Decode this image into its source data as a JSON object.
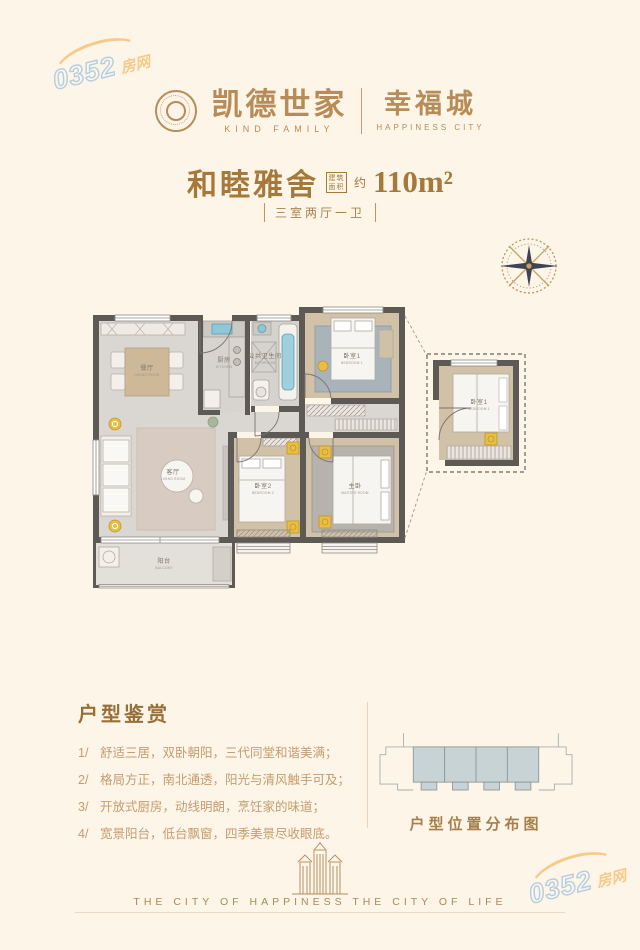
{
  "watermark": {
    "number": "0352",
    "suffix": "房网"
  },
  "header": {
    "brand_cn": "凯德世家",
    "brand_en": "KIND FAMILY",
    "project_cn": "幸福城",
    "project_en": "HAPPINESS CITY"
  },
  "title": {
    "name": "和睦雅舍",
    "area_label": "建筑面积",
    "approx": "约",
    "area_value": "110m²",
    "layout": "三室两厅一卫"
  },
  "floorplan": {
    "rooms": {
      "dining": {
        "cn": "餐厅",
        "en": "DINING ROOM"
      },
      "kitchen": {
        "cn": "厨房",
        "en": "KITCHEN"
      },
      "bath": {
        "cn": "公共卫生间",
        "en": "BATHROOM"
      },
      "bedroom1": {
        "cn": "卧室1",
        "en": "BEDROOM 1"
      },
      "living": {
        "cn": "客厅",
        "en": "LIVING ROOM"
      },
      "bedroom2": {
        "cn": "卧室2",
        "en": "BEDROOM 2"
      },
      "master": {
        "cn": "主卧",
        "en": "MASTER ROOM"
      },
      "balcony": {
        "cn": "阳台",
        "en": "BALCONY"
      },
      "detail": {
        "cn": "卧室1",
        "en": "BEDROOM 1"
      }
    }
  },
  "appreciation": {
    "heading": "户型鉴赏",
    "items": [
      {
        "num": "1/",
        "text": "舒适三居，双卧朝阳，三代同堂和谐美满；"
      },
      {
        "num": "2/",
        "text": "格局方正，南北通透，阳光与清风触手可及；"
      },
      {
        "num": "3/",
        "text": "开放式厨房，动线明朗，烹饪家的味道；"
      },
      {
        "num": "4/",
        "text": "宽景阳台，低台飘窗，四季美景尽收眼底。"
      }
    ]
  },
  "location": {
    "caption": "户型位置分布图"
  },
  "footer": {
    "slogan": "THE CITY OF HAPPINESS THE CITY OF LIFE"
  },
  "colors": {
    "background": "#fcf5e8",
    "accent_gold": "#b78c58",
    "title_brown": "#a6783a",
    "wall_grey": "#5d5a55",
    "wood_floor": "#d0c1a7",
    "marble_floor": "#dad7d2",
    "stool_gold": "#e8bf43",
    "water_blue": "#8fc6d8",
    "unit_fill": "#c7d3d5",
    "watermark_blue": "#7aadd8",
    "watermark_orange": "#f2a83e"
  }
}
